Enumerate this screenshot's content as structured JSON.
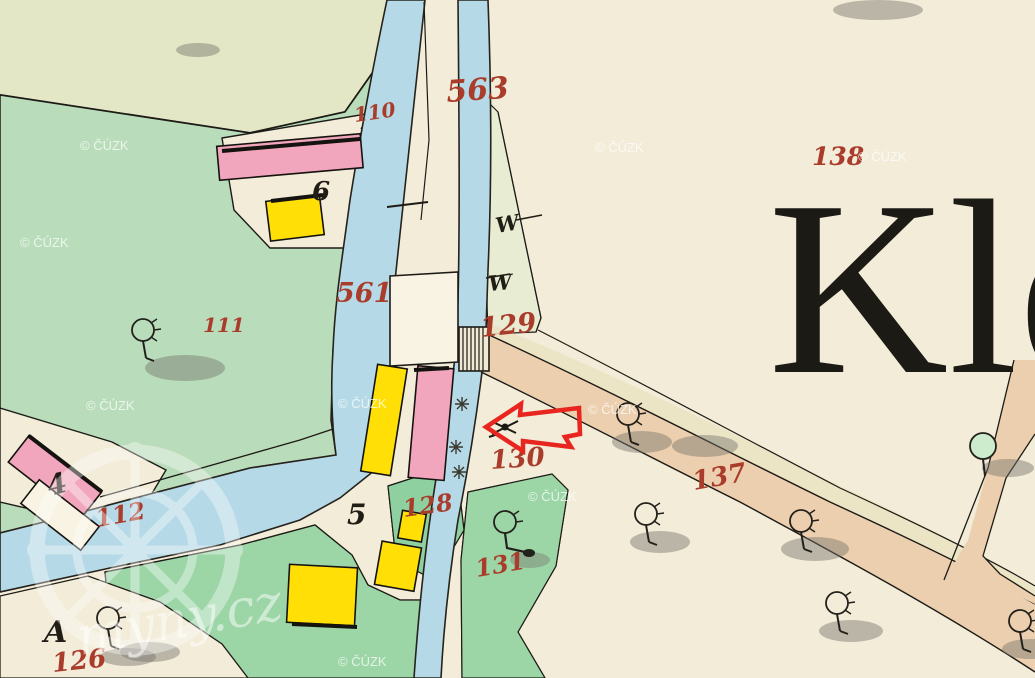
{
  "place_name": "Kle",
  "copyright_watermark": "© ČÚZK",
  "logo_watermark_text": "myny.cz",
  "parcel_numbers": {
    "p110": "110",
    "p563": "563",
    "p138": "138",
    "p111": "111",
    "p561": "561",
    "p129": "129",
    "p130": "130",
    "p112": "112",
    "p128": "128",
    "p137": "137",
    "p131": "131",
    "p126": "126"
  },
  "house_numbers": {
    "h6": "6",
    "h5": "5",
    "h4": "4"
  },
  "letters": {
    "a": "A",
    "w_upper": "W",
    "w_lower": "W"
  },
  "annotation": {
    "type": "arrow",
    "direction": "left",
    "color": "#e8251f"
  },
  "colors": {
    "paper": "#f2ecd8",
    "pale_field": "#e4e7c5",
    "meadow": "#b9dcba",
    "meadow_mid": "#9cd5a6",
    "meadow_dark": "#8ed0a0",
    "water": "#b5d9e6",
    "road": "#eccfae",
    "masonry_pink": "#f2a6bd",
    "wood_yellow": "#ffdf05",
    "number_red": "#a93c2b",
    "ink": "#1c1a15",
    "arrow_red": "#e8251f"
  }
}
